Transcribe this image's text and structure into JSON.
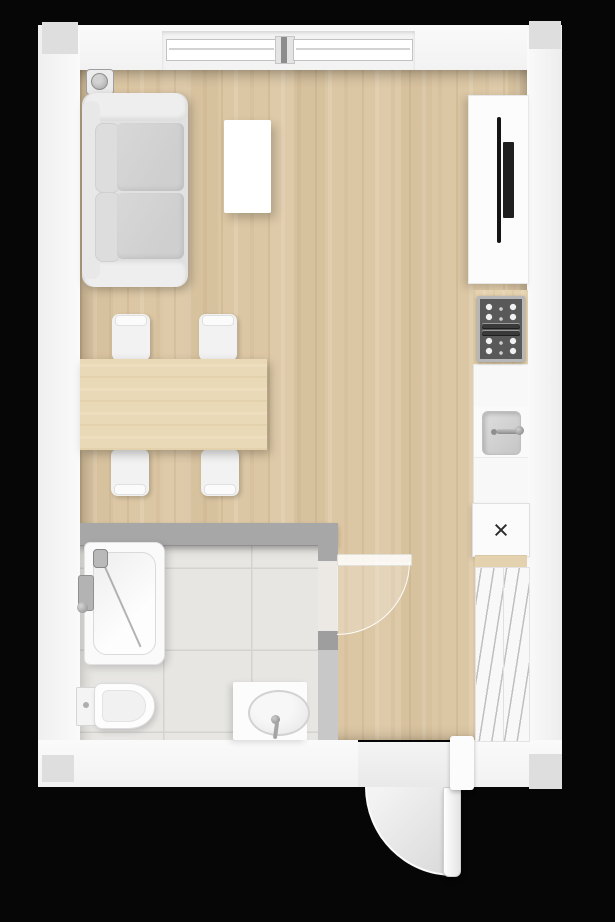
{
  "meta": {
    "view": "top-down-floor-plan",
    "scene": "studio-apartment-with-bathroom"
  },
  "colors": {
    "wall": "#fafafa",
    "wall_corner": "#dedede",
    "partition": "#a7a7a7",
    "partition_light": "#c8c8c8",
    "wood_floor": "#dcc7a4",
    "table_wood": "#ead9b6",
    "counter_wood": "#e4d1ae",
    "tile": "#e7e6e3",
    "tile_grout": "#d4d3d0",
    "sofa_frame": "#e1e1e1",
    "sofa_cushion": "#cfcfcf",
    "metal": "#a0a0a0",
    "cooktop_frame": "#b7b7b7",
    "cooktop_panel": "#595959",
    "tv": "#141414",
    "hatch": "#c0c0c0",
    "mark": "#2b2b2b"
  },
  "symbols": {
    "appliance_marker": "×"
  },
  "rooms": [
    {
      "id": "living-area",
      "floor_material": "wood"
    },
    {
      "id": "bathroom",
      "floor_material": "tile"
    }
  ],
  "furniture": [
    "sofa",
    "coffee-table",
    "dining-table",
    "dining-chair-1",
    "dining-chair-2",
    "dining-chair-3",
    "dining-chair-4",
    "corner-speaker",
    "tv-console",
    "tv",
    "cooktop",
    "kitchen-sink",
    "kitchen-cabinet-1",
    "kitchen-cabinet-2",
    "appliance-cabinet-x",
    "shelf-unit",
    "bathtub",
    "shower-set",
    "toilet",
    "vanity-sink"
  ],
  "doors": [
    "bathroom-door",
    "entry-door"
  ],
  "windows": [
    "top-window-left-pane",
    "top-window-right-pane"
  ]
}
